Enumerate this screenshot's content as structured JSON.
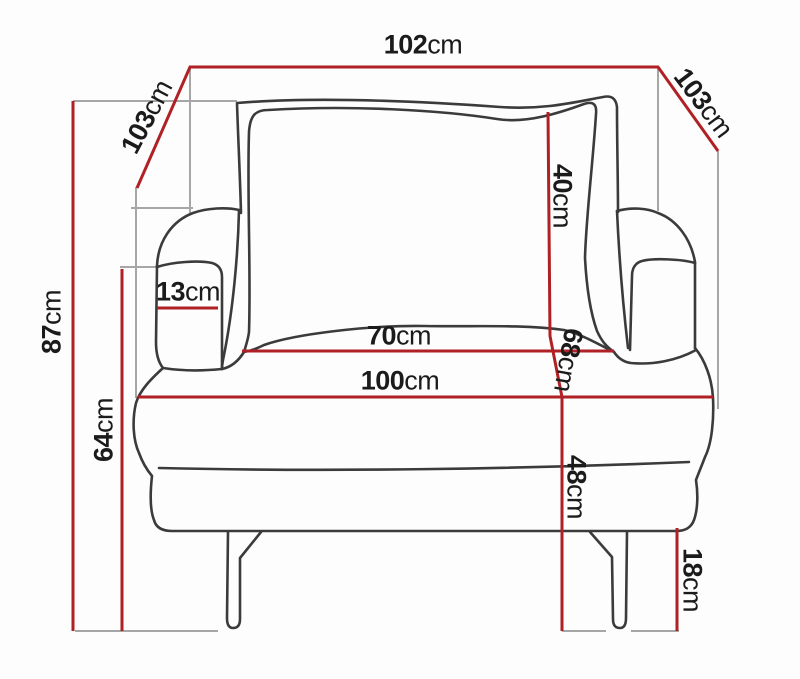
{
  "meta": {
    "title": "Armchair dimension diagram"
  },
  "colors": {
    "dimension_line": "#b02125",
    "guide_line": "#a6a6a6",
    "outline": "#3b3b3b",
    "label_text": "#1b1b1b",
    "background": "#fdfdfd"
  },
  "dimensions": {
    "top_width": {
      "value": "102",
      "unit": "cm"
    },
    "left_depth": {
      "value": "103",
      "unit": "cm"
    },
    "right_depth": {
      "value": "103",
      "unit": "cm"
    },
    "total_height": {
      "value": "87",
      "unit": "cm"
    },
    "armrest_height": {
      "value": "64",
      "unit": "cm"
    },
    "armrest_width": {
      "value": "13",
      "unit": "cm"
    },
    "seat_width": {
      "value": "70",
      "unit": "cm"
    },
    "base_width": {
      "value": "100",
      "unit": "cm"
    },
    "back_cushion_height": {
      "value": "40",
      "unit": "cm"
    },
    "backrest_height": {
      "value": "68",
      "unit": "cm"
    },
    "seat_height": {
      "value": "48",
      "unit": "cm"
    },
    "leg_height": {
      "value": "18",
      "unit": "cm"
    }
  }
}
